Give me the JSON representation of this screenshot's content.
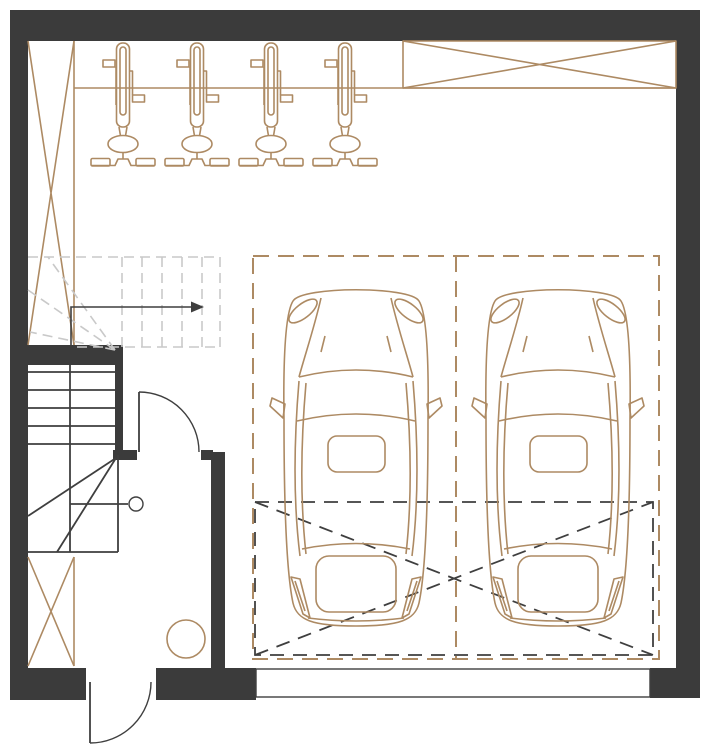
{
  "meta": {
    "title": "Garage floor plan",
    "drawing_type": "architectural plan, no text labels",
    "canvas": {
      "width": 720,
      "height": 755
    }
  },
  "colors": {
    "bg": "#ffffff",
    "wall": "#3b3b3b",
    "line_dark": "#3f3f3f",
    "accent": "#ad8a63",
    "dashed_gray": "#c9c9c9"
  },
  "elements": {
    "bike_racks": {
      "count": 4,
      "label": "vertical bicycle racks (front view symbols)",
      "positions_x": [
        123,
        197,
        271,
        345
      ]
    },
    "cars": {
      "count": 2,
      "label": "cars in plan view, front facing up",
      "offsets_x": [
        0,
        202
      ]
    },
    "parking_spaces": {
      "count": 2,
      "label": "parking bays outlined with long brown dashes"
    },
    "crossed_reserved_area": {
      "count": 1,
      "label": "dark dashed rectangle with X across lower half of bays"
    },
    "columns": {
      "count": 3,
      "label": "cross-braced shafts (X symbols): upper-left, lower-left, top-right header"
    },
    "stairs": {
      "label": "winder staircase: solid lower run, dashed upper run with direction arrow",
      "solid_treads": 5,
      "dashed_treads": 5
    },
    "doors": {
      "count": 3,
      "labels": [
        "exterior entrance door (bottom, swings out)",
        "lobby-to-garage door (swings into lobby)",
        "garage sectional door (bottom right opening)"
      ]
    },
    "floor_drain": {
      "count": 1,
      "label": "circle in vestibule"
    }
  }
}
